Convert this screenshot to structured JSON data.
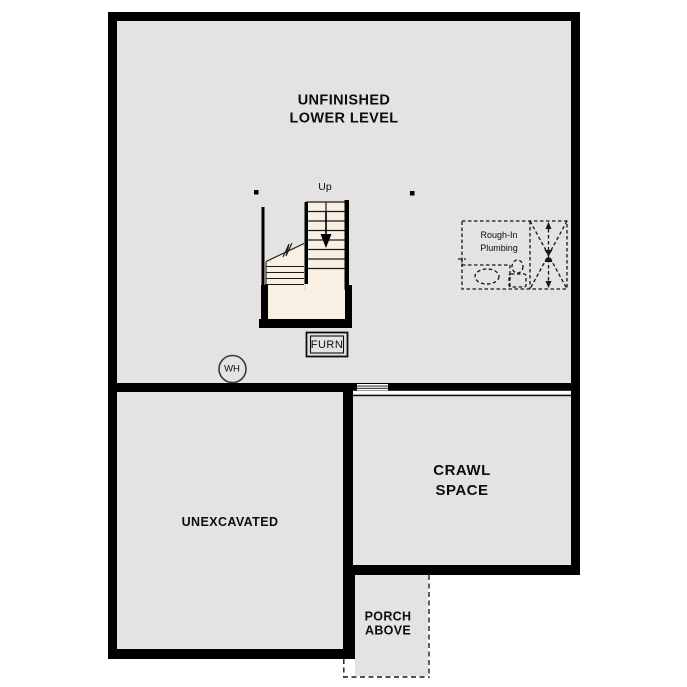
{
  "title": {
    "line1": "UNFINISHED",
    "line2": "LOWER LEVEL"
  },
  "rooms": {
    "unexcavated": "UNEXCAVATED",
    "crawl_space": {
      "line1": "CRAWL",
      "line2": "SPACE"
    },
    "porch": {
      "line1": "PORCH",
      "line2": "ABOVE"
    }
  },
  "stairs": {
    "direction_label": "Up"
  },
  "equipment": {
    "furnace": "FURN",
    "water_heater": "WH"
  },
  "plumbing": {
    "line1": "Rough-In",
    "line2": "Plumbing"
  },
  "colors": {
    "wall": "#000000",
    "floor": "#e4e3e1",
    "stair_fill": "#f8f1e3",
    "background": "#ffffff",
    "line": "#111111"
  }
}
